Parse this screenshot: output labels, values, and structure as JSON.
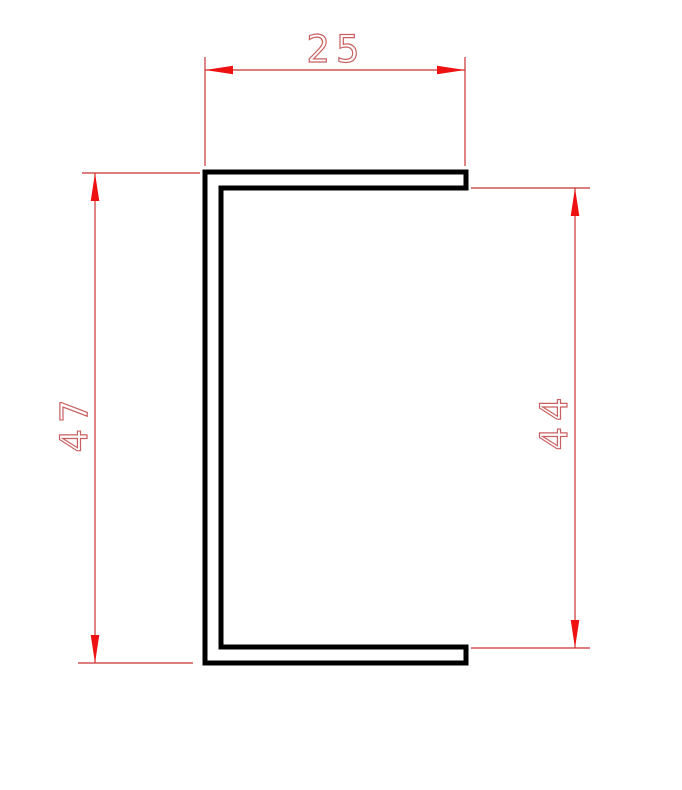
{
  "drawing": {
    "kind": "c-channel-profile-cross-section"
  },
  "dimensions": {
    "top_width": {
      "value": "25",
      "orientation": "horizontal"
    },
    "left_height": {
      "value": "47",
      "orientation": "vertical"
    },
    "right_inner_height": {
      "value": "44",
      "orientation": "vertical"
    }
  },
  "colors": {
    "background": "#ffffff",
    "profile_line": "#000000",
    "dim_line": "#c83232",
    "arrow": "#ee1111",
    "dim_text": "#c86060"
  }
}
